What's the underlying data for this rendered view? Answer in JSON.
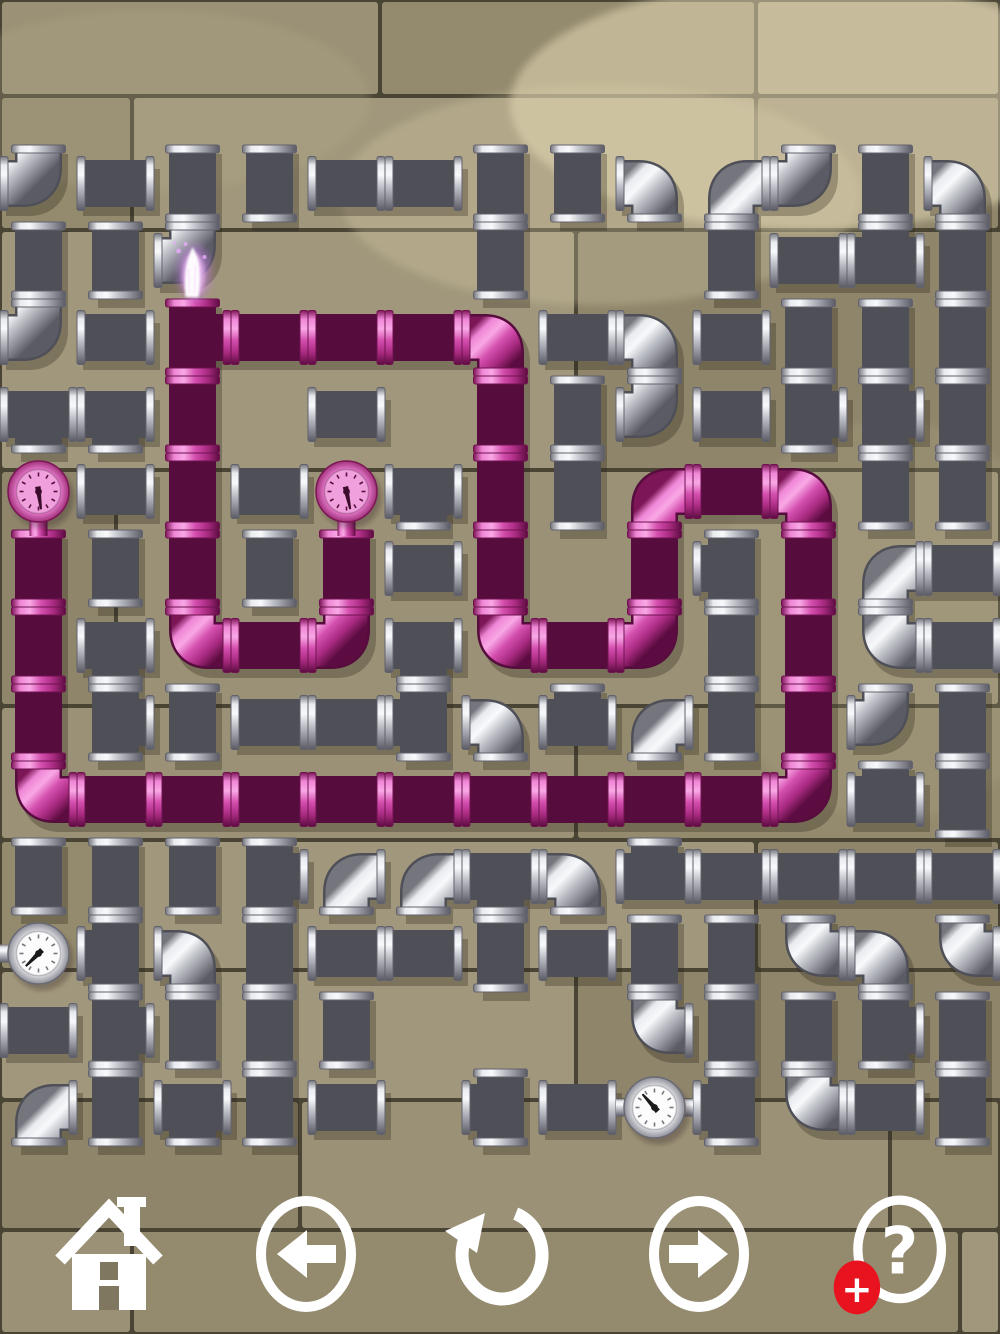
{
  "toolbar": {
    "icon_color": "#ffffff",
    "badge_color": "#e8131f",
    "help_glyph": "?",
    "plus_glyph": "+",
    "buttons": [
      {
        "id": "home",
        "label": "Home"
      },
      {
        "id": "previous",
        "label": "Previous"
      },
      {
        "id": "undo",
        "label": "Undo"
      },
      {
        "id": "next",
        "label": "Next"
      },
      {
        "id": "help",
        "label": "Help"
      }
    ]
  },
  "board": {
    "grid": {
      "x": 0,
      "y": 145,
      "cell": 77,
      "cols": 13,
      "rows": 13
    },
    "palette": {
      "gray_stops": [
        [
          "0",
          "#75757d"
        ],
        [
          "0.16",
          "#e9ebef"
        ],
        [
          "0.34",
          "#f8f9fb"
        ],
        [
          "0.55",
          "#c2c4cb"
        ],
        [
          "0.78",
          "#8f8f99"
        ],
        [
          "1",
          "#5b5b65"
        ]
      ],
      "pink_stops": [
        [
          "0",
          "#7c1656"
        ],
        [
          "0.16",
          "#ef86d6"
        ],
        [
          "0.34",
          "#f9a8e6"
        ],
        [
          "0.55",
          "#d44fae"
        ],
        [
          "0.78",
          "#a82a80"
        ],
        [
          "1",
          "#5c0c40"
        ]
      ],
      "gray_underlay": "#4f4f58",
      "pink_underlay": "#560c3d",
      "shadow": "rgba(44,38,24,0.30)",
      "gray_flange_stroke": "#62626c",
      "pink_flange_stroke": "#6e1250"
    },
    "background": {
      "grout": "#4a4435",
      "tones": [
        "#9b9176",
        "#948a6e",
        "#a1977c",
        "#8e856b"
      ],
      "rows": [
        {
          "y": 0,
          "h": 96,
          "splits": [
            380,
            756
          ]
        },
        {
          "y": 96,
          "h": 134,
          "splits": [
            132,
            756
          ]
        },
        {
          "y": 230,
          "h": 240,
          "splits": [
            576,
            1140
          ]
        },
        {
          "y": 470,
          "h": 236,
          "splits": [
            116
          ]
        },
        {
          "y": 706,
          "h": 134,
          "splits": [
            576,
            1144
          ]
        },
        {
          "y": 840,
          "h": 130,
          "splits": [
            132,
            756
          ]
        },
        {
          "y": 970,
          "h": 130,
          "splits": [
            576,
            1140
          ]
        },
        {
          "y": 1100,
          "h": 130,
          "splits": [
            300,
            890
          ]
        },
        {
          "y": 1230,
          "h": 104,
          "splits": [
            132,
            960
          ]
        }
      ],
      "sheens": [
        {
          "cx": 810,
          "cy": 105,
          "rx": 300,
          "ry": 125,
          "fill": "#ece2bd",
          "o": 0.5
        },
        {
          "cx": 600,
          "cy": 195,
          "rx": 260,
          "ry": 110,
          "fill": "#ded3ad",
          "o": 0.28
        },
        {
          "cx": 150,
          "cy": 100,
          "rx": 220,
          "ry": 90,
          "fill": "#b5ab8b",
          "o": 0.25
        },
        {
          "cx": 890,
          "cy": 620,
          "rx": 180,
          "ry": 200,
          "fill": "#b8ad8c",
          "o": 0.2
        }
      ]
    },
    "pieces": [
      [
        0,
        0,
        "e",
        "NW",
        "gray"
      ],
      [
        1,
        0,
        "h",
        "",
        "gray"
      ],
      [
        2,
        0,
        "v",
        "",
        "gray"
      ],
      [
        3,
        0,
        "v",
        "",
        "gray"
      ],
      [
        4,
        0,
        "h",
        "",
        "gray"
      ],
      [
        5,
        0,
        "h",
        "",
        "gray"
      ],
      [
        6,
        0,
        "v",
        "",
        "gray"
      ],
      [
        7,
        0,
        "v",
        "",
        "gray"
      ],
      [
        8,
        0,
        "e",
        "SW",
        "gray"
      ],
      [
        9,
        0,
        "e",
        "SE",
        "gray"
      ],
      [
        10,
        0,
        "e",
        "NW",
        "gray"
      ],
      [
        11,
        0,
        "v",
        "",
        "gray"
      ],
      [
        12,
        0,
        "e",
        "SW",
        "gray"
      ],
      [
        0,
        1,
        "v",
        "",
        "gray"
      ],
      [
        1,
        1,
        "v",
        "",
        "gray"
      ],
      [
        2,
        1,
        "e",
        "NW",
        "gray"
      ],
      [
        6,
        1,
        "v",
        "",
        "gray"
      ],
      [
        9,
        1,
        "v",
        "",
        "gray"
      ],
      [
        10,
        1,
        "h",
        "",
        "gray"
      ],
      [
        11,
        1,
        "t",
        "LRU",
        "gray"
      ],
      [
        12,
        1,
        "v",
        "",
        "gray"
      ],
      [
        0,
        2,
        "e",
        "NW",
        "gray"
      ],
      [
        1,
        2,
        "h",
        "",
        "gray"
      ],
      [
        2,
        2,
        "t",
        "UDR",
        "pink"
      ],
      [
        3,
        2,
        "h",
        "",
        "pink"
      ],
      [
        4,
        2,
        "h",
        "",
        "pink"
      ],
      [
        5,
        2,
        "h",
        "",
        "pink"
      ],
      [
        6,
        2,
        "e",
        "SW",
        "pink"
      ],
      [
        7,
        2,
        "h",
        "",
        "gray"
      ],
      [
        8,
        2,
        "e",
        "SW",
        "gray"
      ],
      [
        9,
        2,
        "h",
        "",
        "gray"
      ],
      [
        10,
        2,
        "v",
        "",
        "gray"
      ],
      [
        11,
        2,
        "v",
        "",
        "gray"
      ],
      [
        12,
        2,
        "v",
        "",
        "gray"
      ],
      [
        0,
        3,
        "t",
        "LRD",
        "gray"
      ],
      [
        1,
        3,
        "t",
        "LRD",
        "gray"
      ],
      [
        2,
        3,
        "v",
        "",
        "pink"
      ],
      [
        4,
        3,
        "h",
        "",
        "gray"
      ],
      [
        6,
        3,
        "v",
        "",
        "pink"
      ],
      [
        7,
        3,
        "v",
        "",
        "gray"
      ],
      [
        8,
        3,
        "e",
        "NW",
        "gray"
      ],
      [
        9,
        3,
        "h",
        "",
        "gray"
      ],
      [
        10,
        3,
        "t",
        "UDR",
        "gray"
      ],
      [
        11,
        3,
        "t",
        "UDR",
        "gray"
      ],
      [
        12,
        3,
        "v",
        "",
        "gray"
      ],
      [
        1,
        4,
        "h",
        "",
        "gray"
      ],
      [
        2,
        4,
        "v",
        "",
        "pink"
      ],
      [
        3,
        4,
        "h",
        "",
        "gray"
      ],
      [
        5,
        4,
        "t",
        "LRD",
        "gray"
      ],
      [
        6,
        4,
        "v",
        "",
        "pink"
      ],
      [
        7,
        4,
        "v",
        "",
        "gray"
      ],
      [
        8,
        4,
        "e",
        "SE",
        "pink"
      ],
      [
        9,
        4,
        "h",
        "",
        "pink"
      ],
      [
        10,
        4,
        "e",
        "SW",
        "pink"
      ],
      [
        11,
        4,
        "v",
        "",
        "gray"
      ],
      [
        12,
        4,
        "v",
        "",
        "gray"
      ],
      [
        0,
        5,
        "v",
        "",
        "pink"
      ],
      [
        1,
        5,
        "v",
        "",
        "gray"
      ],
      [
        2,
        5,
        "v",
        "",
        "pink"
      ],
      [
        3,
        5,
        "v",
        "",
        "gray"
      ],
      [
        4,
        5,
        "v",
        "",
        "pink"
      ],
      [
        5,
        5,
        "h",
        "",
        "gray"
      ],
      [
        6,
        5,
        "v",
        "",
        "pink"
      ],
      [
        8,
        5,
        "v",
        "",
        "pink"
      ],
      [
        9,
        5,
        "t",
        "UDL",
        "gray"
      ],
      [
        10,
        5,
        "v",
        "",
        "pink"
      ],
      [
        11,
        5,
        "e",
        "SE",
        "gray"
      ],
      [
        12,
        5,
        "h",
        "",
        "gray"
      ],
      [
        0,
        6,
        "v",
        "",
        "pink"
      ],
      [
        1,
        6,
        "t",
        "LRD",
        "gray"
      ],
      [
        2,
        6,
        "e",
        "NE",
        "pink"
      ],
      [
        3,
        6,
        "h",
        "",
        "pink"
      ],
      [
        4,
        6,
        "e",
        "NW",
        "pink"
      ],
      [
        5,
        6,
        "t",
        "LRD",
        "gray"
      ],
      [
        6,
        6,
        "e",
        "NE",
        "pink"
      ],
      [
        7,
        6,
        "h",
        "",
        "pink"
      ],
      [
        8,
        6,
        "e",
        "NW",
        "pink"
      ],
      [
        9,
        6,
        "v",
        "",
        "gray"
      ],
      [
        10,
        6,
        "v",
        "",
        "pink"
      ],
      [
        11,
        6,
        "e",
        "NE",
        "gray"
      ],
      [
        12,
        6,
        "h",
        "",
        "gray"
      ],
      [
        0,
        7,
        "v",
        "",
        "pink"
      ],
      [
        1,
        7,
        "t",
        "UDR",
        "gray"
      ],
      [
        2,
        7,
        "v",
        "",
        "gray"
      ],
      [
        3,
        7,
        "h",
        "",
        "gray"
      ],
      [
        4,
        7,
        "h",
        "",
        "gray"
      ],
      [
        5,
        7,
        "t",
        "UDL",
        "gray"
      ],
      [
        6,
        7,
        "e",
        "SW",
        "gray"
      ],
      [
        7,
        7,
        "t",
        "LRU",
        "gray"
      ],
      [
        8,
        7,
        "e",
        "SE",
        "gray"
      ],
      [
        9,
        7,
        "v",
        "",
        "gray"
      ],
      [
        10,
        7,
        "v",
        "",
        "pink"
      ],
      [
        11,
        7,
        "e",
        "NW",
        "gray"
      ],
      [
        12,
        7,
        "v",
        "",
        "gray"
      ],
      [
        0,
        8,
        "e",
        "NE",
        "pink"
      ],
      [
        1,
        8,
        "h",
        "",
        "pink"
      ],
      [
        2,
        8,
        "h",
        "",
        "pink"
      ],
      [
        3,
        8,
        "h",
        "",
        "pink"
      ],
      [
        4,
        8,
        "h",
        "",
        "pink"
      ],
      [
        5,
        8,
        "h",
        "",
        "pink"
      ],
      [
        6,
        8,
        "h",
        "",
        "pink"
      ],
      [
        7,
        8,
        "h",
        "",
        "pink"
      ],
      [
        8,
        8,
        "h",
        "",
        "pink"
      ],
      [
        9,
        8,
        "h",
        "",
        "pink"
      ],
      [
        10,
        8,
        "e",
        "NW",
        "pink"
      ],
      [
        11,
        8,
        "t",
        "LRU",
        "gray"
      ],
      [
        12,
        8,
        "v",
        "",
        "gray"
      ],
      [
        0,
        9,
        "v",
        "",
        "gray"
      ],
      [
        1,
        9,
        "v",
        "",
        "gray"
      ],
      [
        2,
        9,
        "v",
        "",
        "gray"
      ],
      [
        3,
        9,
        "t",
        "UDR",
        "gray"
      ],
      [
        4,
        9,
        "e",
        "SE",
        "gray"
      ],
      [
        5,
        9,
        "e",
        "SE",
        "gray"
      ],
      [
        6,
        9,
        "t",
        "LRD",
        "gray"
      ],
      [
        7,
        9,
        "e",
        "SW",
        "gray"
      ],
      [
        8,
        9,
        "t",
        "LRU",
        "gray"
      ],
      [
        9,
        9,
        "h",
        "",
        "gray"
      ],
      [
        10,
        9,
        "h",
        "",
        "gray"
      ],
      [
        11,
        9,
        "h",
        "",
        "gray"
      ],
      [
        12,
        9,
        "h",
        "",
        "gray"
      ],
      [
        1,
        10,
        "t",
        "UDL",
        "gray"
      ],
      [
        2,
        10,
        "e",
        "SW",
        "gray"
      ],
      [
        3,
        10,
        "v",
        "",
        "gray"
      ],
      [
        4,
        10,
        "h",
        "",
        "gray"
      ],
      [
        5,
        10,
        "h",
        "",
        "gray"
      ],
      [
        6,
        10,
        "v",
        "",
        "gray"
      ],
      [
        7,
        10,
        "h",
        "",
        "gray"
      ],
      [
        8,
        10,
        "v",
        "",
        "gray"
      ],
      [
        9,
        10,
        "v",
        "",
        "gray"
      ],
      [
        10,
        10,
        "e",
        "NE",
        "gray"
      ],
      [
        11,
        10,
        "e",
        "SW",
        "gray"
      ],
      [
        12,
        10,
        "e",
        "NE",
        "gray"
      ],
      [
        0,
        11,
        "h",
        "",
        "gray"
      ],
      [
        1,
        11,
        "t",
        "UDR",
        "gray"
      ],
      [
        2,
        11,
        "v",
        "",
        "gray"
      ],
      [
        3,
        11,
        "v",
        "",
        "gray"
      ],
      [
        4,
        11,
        "v",
        "",
        "gray"
      ],
      [
        8,
        11,
        "e",
        "NE",
        "gray"
      ],
      [
        9,
        11,
        "v",
        "",
        "gray"
      ],
      [
        10,
        11,
        "v",
        "",
        "gray"
      ],
      [
        11,
        11,
        "t",
        "UDR",
        "gray"
      ],
      [
        12,
        11,
        "v",
        "",
        "gray"
      ],
      [
        0,
        12,
        "e",
        "SE",
        "gray"
      ],
      [
        1,
        12,
        "v",
        "",
        "gray"
      ],
      [
        2,
        12,
        "t",
        "LRD",
        "gray"
      ],
      [
        3,
        12,
        "v",
        "",
        "gray"
      ],
      [
        4,
        12,
        "h",
        "",
        "gray"
      ],
      [
        6,
        12,
        "t",
        "UDL",
        "gray"
      ],
      [
        7,
        12,
        "h",
        "",
        "gray"
      ],
      [
        9,
        12,
        "t",
        "UDL",
        "gray"
      ],
      [
        10,
        12,
        "e",
        "NE",
        "gray"
      ],
      [
        11,
        12,
        "h",
        "",
        "gray"
      ],
      [
        12,
        12,
        "v",
        "",
        "gray"
      ]
    ],
    "gauges": [
      {
        "col": 0,
        "row": 4,
        "style": "pink",
        "mount": "D",
        "needle": 172
      },
      {
        "col": 4,
        "row": 4,
        "style": "pink",
        "mount": "D",
        "needle": 168
      },
      {
        "col": 0,
        "row": 10,
        "style": "white",
        "mount": "L",
        "needle": 225
      },
      {
        "col": 8,
        "row": 12,
        "style": "white",
        "mount": "LR",
        "needle": 318
      }
    ],
    "flame": {
      "col": 2,
      "row": 1
    },
    "gauge_styles": {
      "pink": {
        "rim": [
          "#ffd0f1",
          "#e377c8",
          "#a03279"
        ],
        "face": "#f0a0dc",
        "tick": "#57123f",
        "needle": "#3d0c2c",
        "stroke": "#7c1656"
      },
      "white": {
        "rim": [
          "#ffffff",
          "#dcdce2",
          "#8f8f99"
        ],
        "face": "#fcfcfd",
        "tick": "#77777f",
        "needle": "#1a1a1a",
        "stroke": "#6a6a74"
      }
    }
  }
}
